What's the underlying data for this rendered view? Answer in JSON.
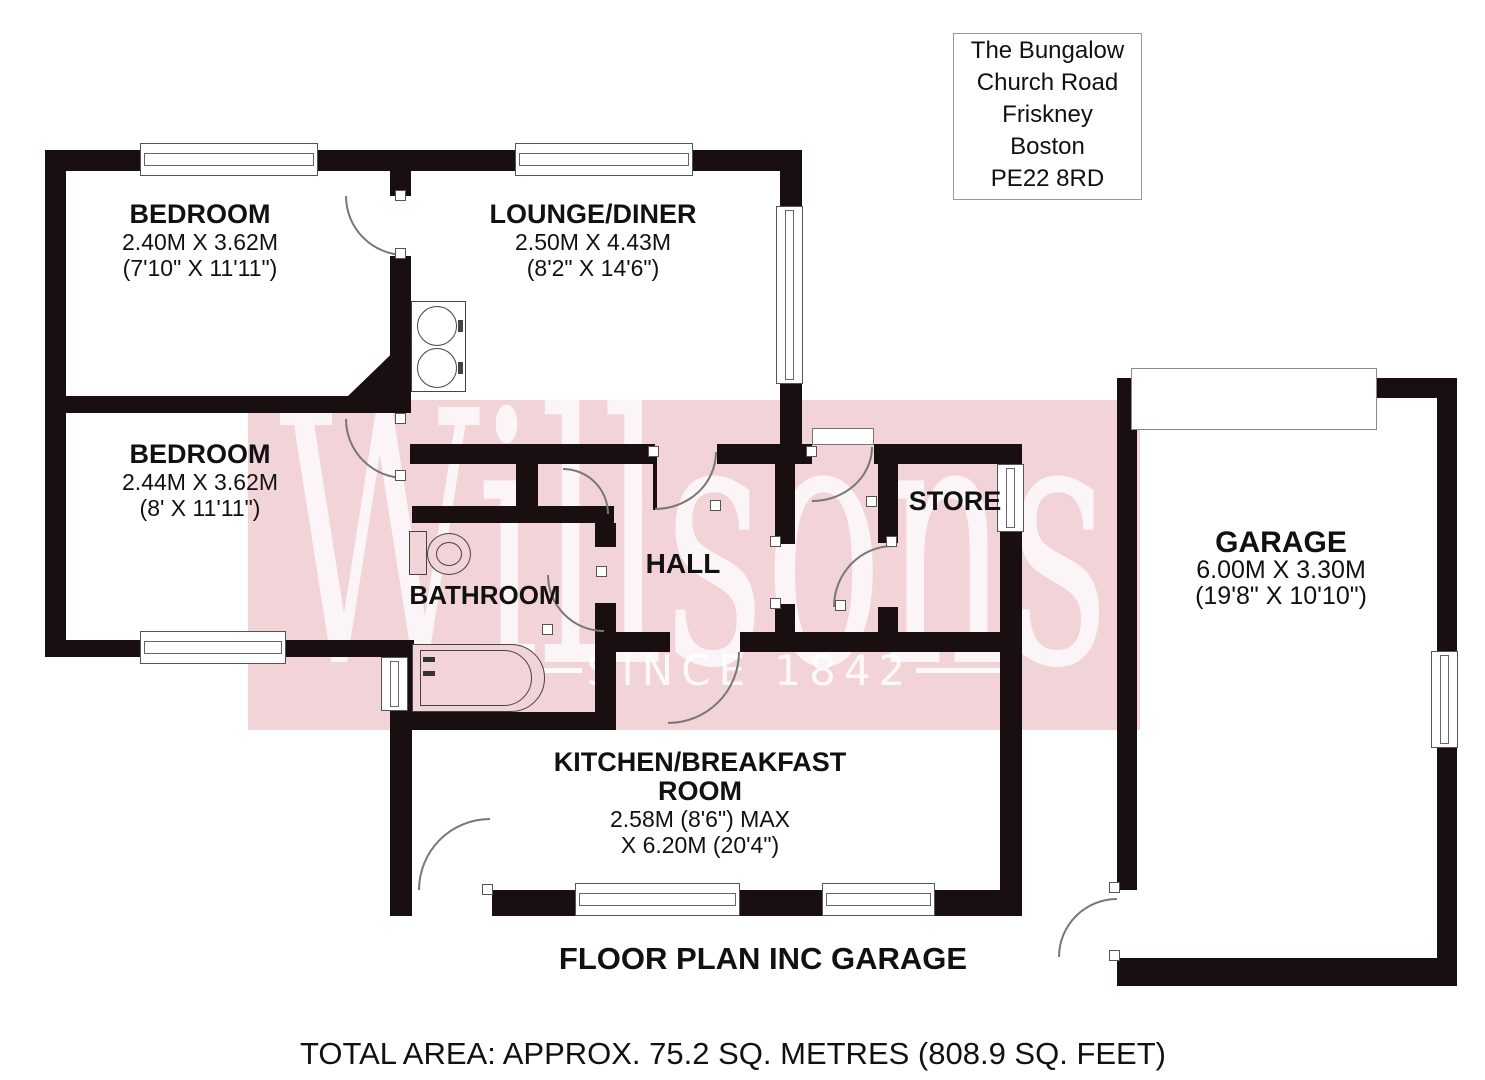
{
  "address": {
    "lines": [
      "The Bungalow",
      "Church Road",
      "Friskney",
      "Boston",
      "PE22 8RD"
    ]
  },
  "watermark": {
    "brand": "Willsons",
    "tagline": "SINCE 1842"
  },
  "rooms": {
    "bedroom1": {
      "name": "BEDROOM",
      "metric": "2.40M X 3.62M",
      "imperial": "(7'10\" X 11'11\")"
    },
    "lounge": {
      "name": "LOUNGE/DINER",
      "metric": "2.50M X 4.43M",
      "imperial": "(8'2\" X 14'6\")"
    },
    "bedroom2": {
      "name": "BEDROOM",
      "metric": "2.44M X 3.62M",
      "imperial": "(8' X 11'11\")"
    },
    "bathroom": {
      "name": "BATHROOM"
    },
    "hall": {
      "name": "HALL"
    },
    "store": {
      "name": "STORE"
    },
    "garage": {
      "name": "GARAGE",
      "metric": "6.00M X 3.30M",
      "imperial": "(19'8\" X 10'10\")"
    },
    "kitchen": {
      "name_line1": "KITCHEN/BREAKFAST",
      "name_line2": "ROOM",
      "metric": "2.58M (8'6\") MAX",
      "imperial": "X 6.20M (20'4\")"
    }
  },
  "footer": {
    "plan_title": "FLOOR PLAN INC GARAGE",
    "total_area": "TOTAL AREA: APPROX. 75.2 SQ. METRES (808.9 SQ. FEET)"
  },
  "colors": {
    "wall": "#1a0f10",
    "watermark_pink": "#f2d3d8",
    "label": "#111111",
    "outline": "#777777"
  }
}
